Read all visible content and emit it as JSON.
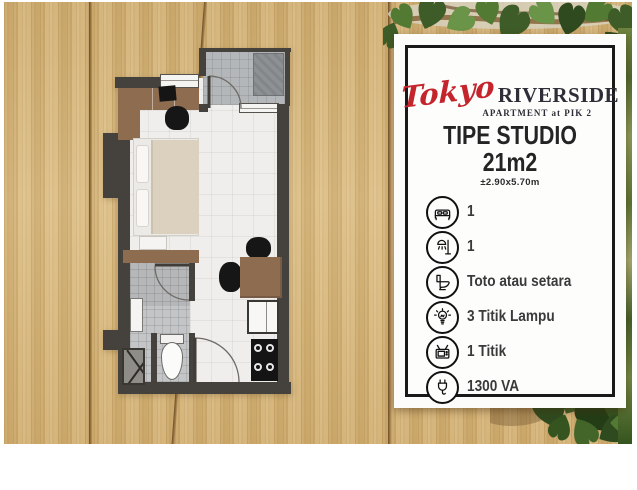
{
  "card": {
    "brand_script": "Tokyo",
    "brand_name": "RIVERSIDE",
    "brand_sub": "APARTMENT at PIK 2",
    "type_title": "TIPE STUDIO",
    "type_size": "21m2",
    "type_dims": "±2.90x5.70m",
    "specs": [
      {
        "icon": "bed-icon",
        "label": "1"
      },
      {
        "icon": "shower-icon",
        "label": "1"
      },
      {
        "icon": "toilet-icon",
        "label": "Toto atau setara"
      },
      {
        "icon": "lightbulb-icon",
        "label": "3 Titik Lampu"
      },
      {
        "icon": "tv-icon",
        "label": "1 Titik"
      },
      {
        "icon": "power-plug-icon",
        "label": "1300 VA"
      }
    ]
  },
  "floorplan": {
    "features": [
      "balcony",
      "ac-unit",
      "balcony-door",
      "window",
      "desk-with-monitor",
      "desk-chair",
      "bed",
      "nightstand",
      "wardrobe",
      "bathroom",
      "bath-sink",
      "toilet",
      "shaft",
      "dining-table",
      "dining-chairs",
      "kitchen-sink",
      "stove",
      "entry-door"
    ]
  },
  "colors": {
    "accent_red": "#c4252d",
    "wood": "#d7b576",
    "leaf_green": "#527a33",
    "card_border": "#191919",
    "wall": "#45413d"
  }
}
